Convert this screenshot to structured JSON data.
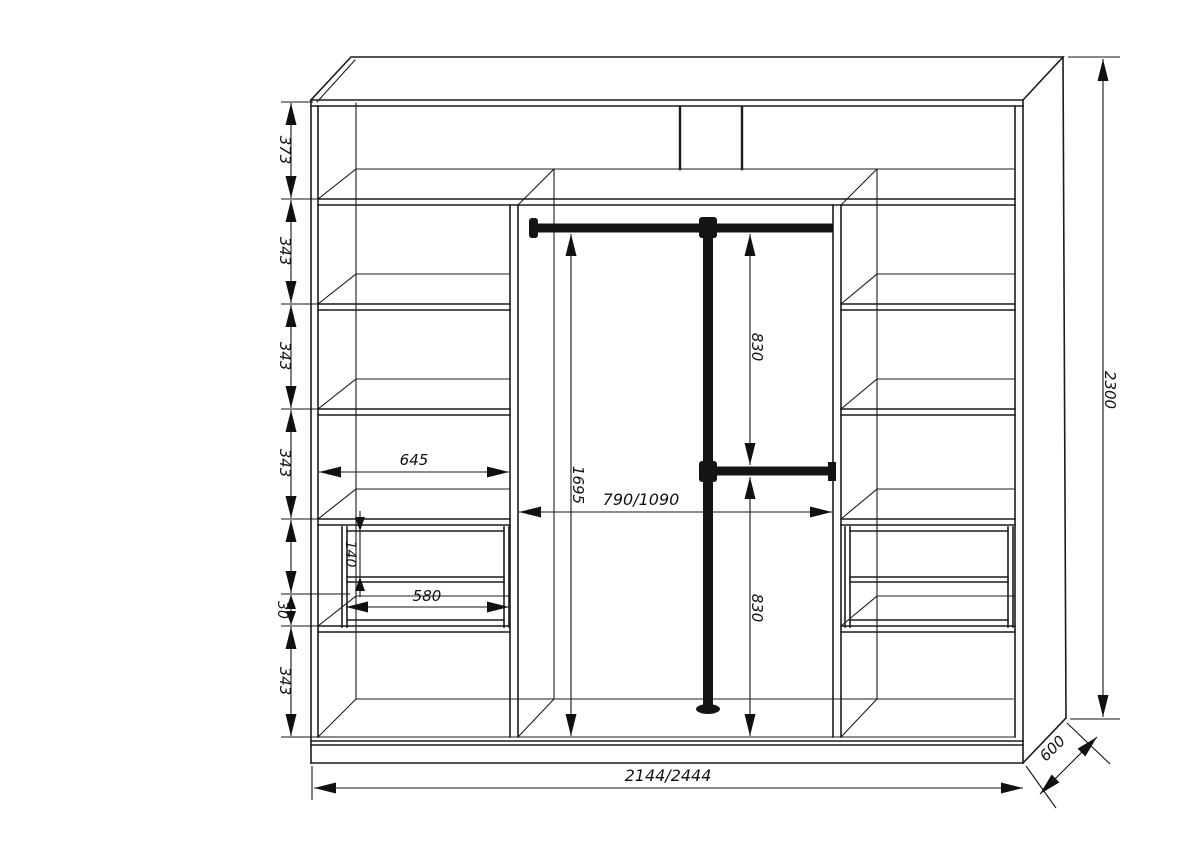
{
  "colors": {
    "background": "#ffffff",
    "line": "#1c1c1c",
    "rod": "#141414",
    "text": "#111111"
  },
  "dimensions": {
    "left_chain": {
      "top_section": "373",
      "section2": "343",
      "section3": "343",
      "section4": "343",
      "plinth_gap": "30",
      "bottom_section": "343"
    },
    "drawers": {
      "front_height": "140",
      "width": "580"
    },
    "left_shelf_width": "645",
    "center": {
      "rod_height": "1695",
      "width": "790/1090",
      "upper_gap": "830",
      "lower_gap": "830"
    },
    "overall": {
      "width": "2144/2444",
      "height": "2300",
      "depth": "600"
    }
  }
}
